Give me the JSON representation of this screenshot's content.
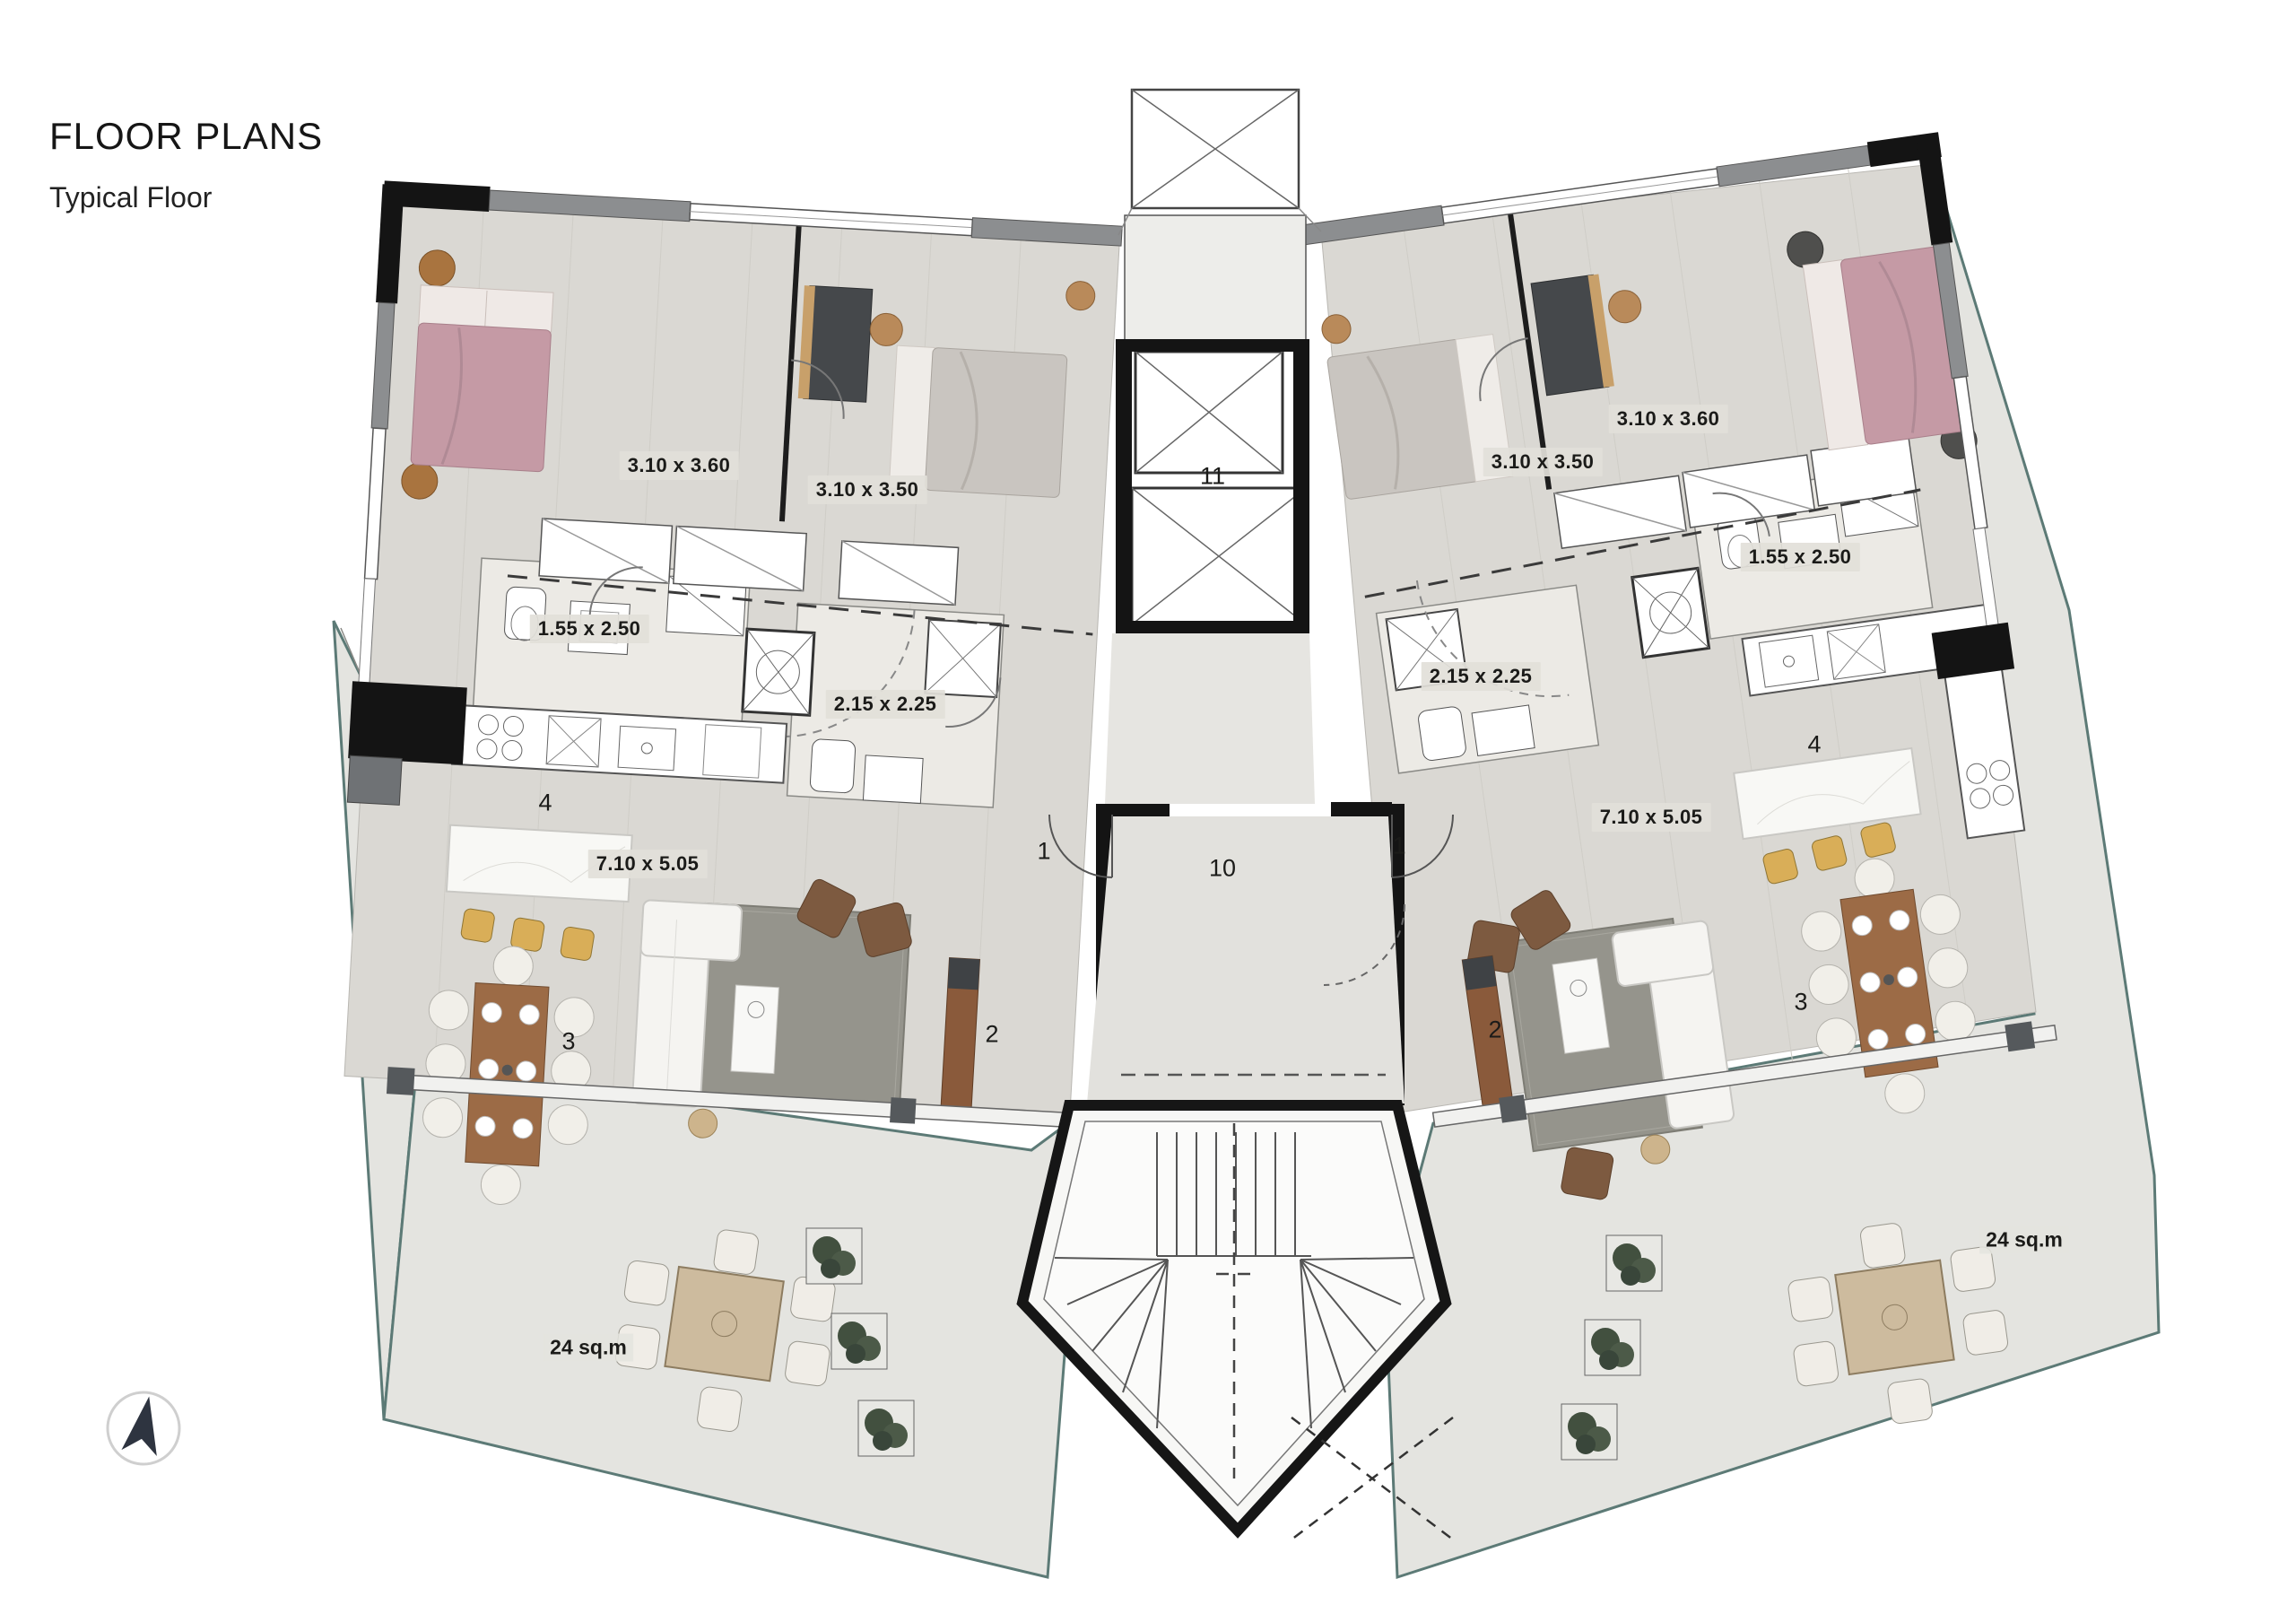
{
  "header": {
    "title": "FLOOR PLANS",
    "subtitle": "Typical Floor"
  },
  "core": {
    "elevator_no": "11",
    "lobby_no": "10"
  },
  "units": {
    "left": {
      "bedroom1_dim": "3.10 x 3.60",
      "bedroom2_dim": "3.10 x 3.50",
      "bathroom1_dim": "1.55 x 2.50",
      "bathroom2_dim": "2.15 x 2.25",
      "living_dim": "7.10 x 5.05",
      "terrace_area": "24 sq.m",
      "entrance_no": "1",
      "living_no": "2",
      "dining_no": "3",
      "kitchen_no": "4"
    },
    "right": {
      "bedroom1_dim": "3.10 x 3.60",
      "bedroom2_dim": "3.10 x 3.50",
      "bathroom1_dim": "1.55 x 2.50",
      "bathroom2_dim": "2.15 x 2.25",
      "living_dim": "7.10 x 5.05",
      "terrace_area": "24 sq.m",
      "entrance_no": "1",
      "living_no": "2",
      "dining_no": "3",
      "kitchen_no": "4"
    }
  },
  "compass": {
    "icon": "north-arrow"
  },
  "colors": {
    "wall": "#161616",
    "floor_wood": "#dad8d3",
    "floor_terrace": "#e4e4e0",
    "floor_bath": "#eceae5",
    "bed_pink": "#c59aa5",
    "bed_gray": "#c9c5c0",
    "stool_yellow": "#d9ae58",
    "wood": "#9c6b46",
    "glass": "#5c7a76",
    "rug": "#95948c"
  }
}
